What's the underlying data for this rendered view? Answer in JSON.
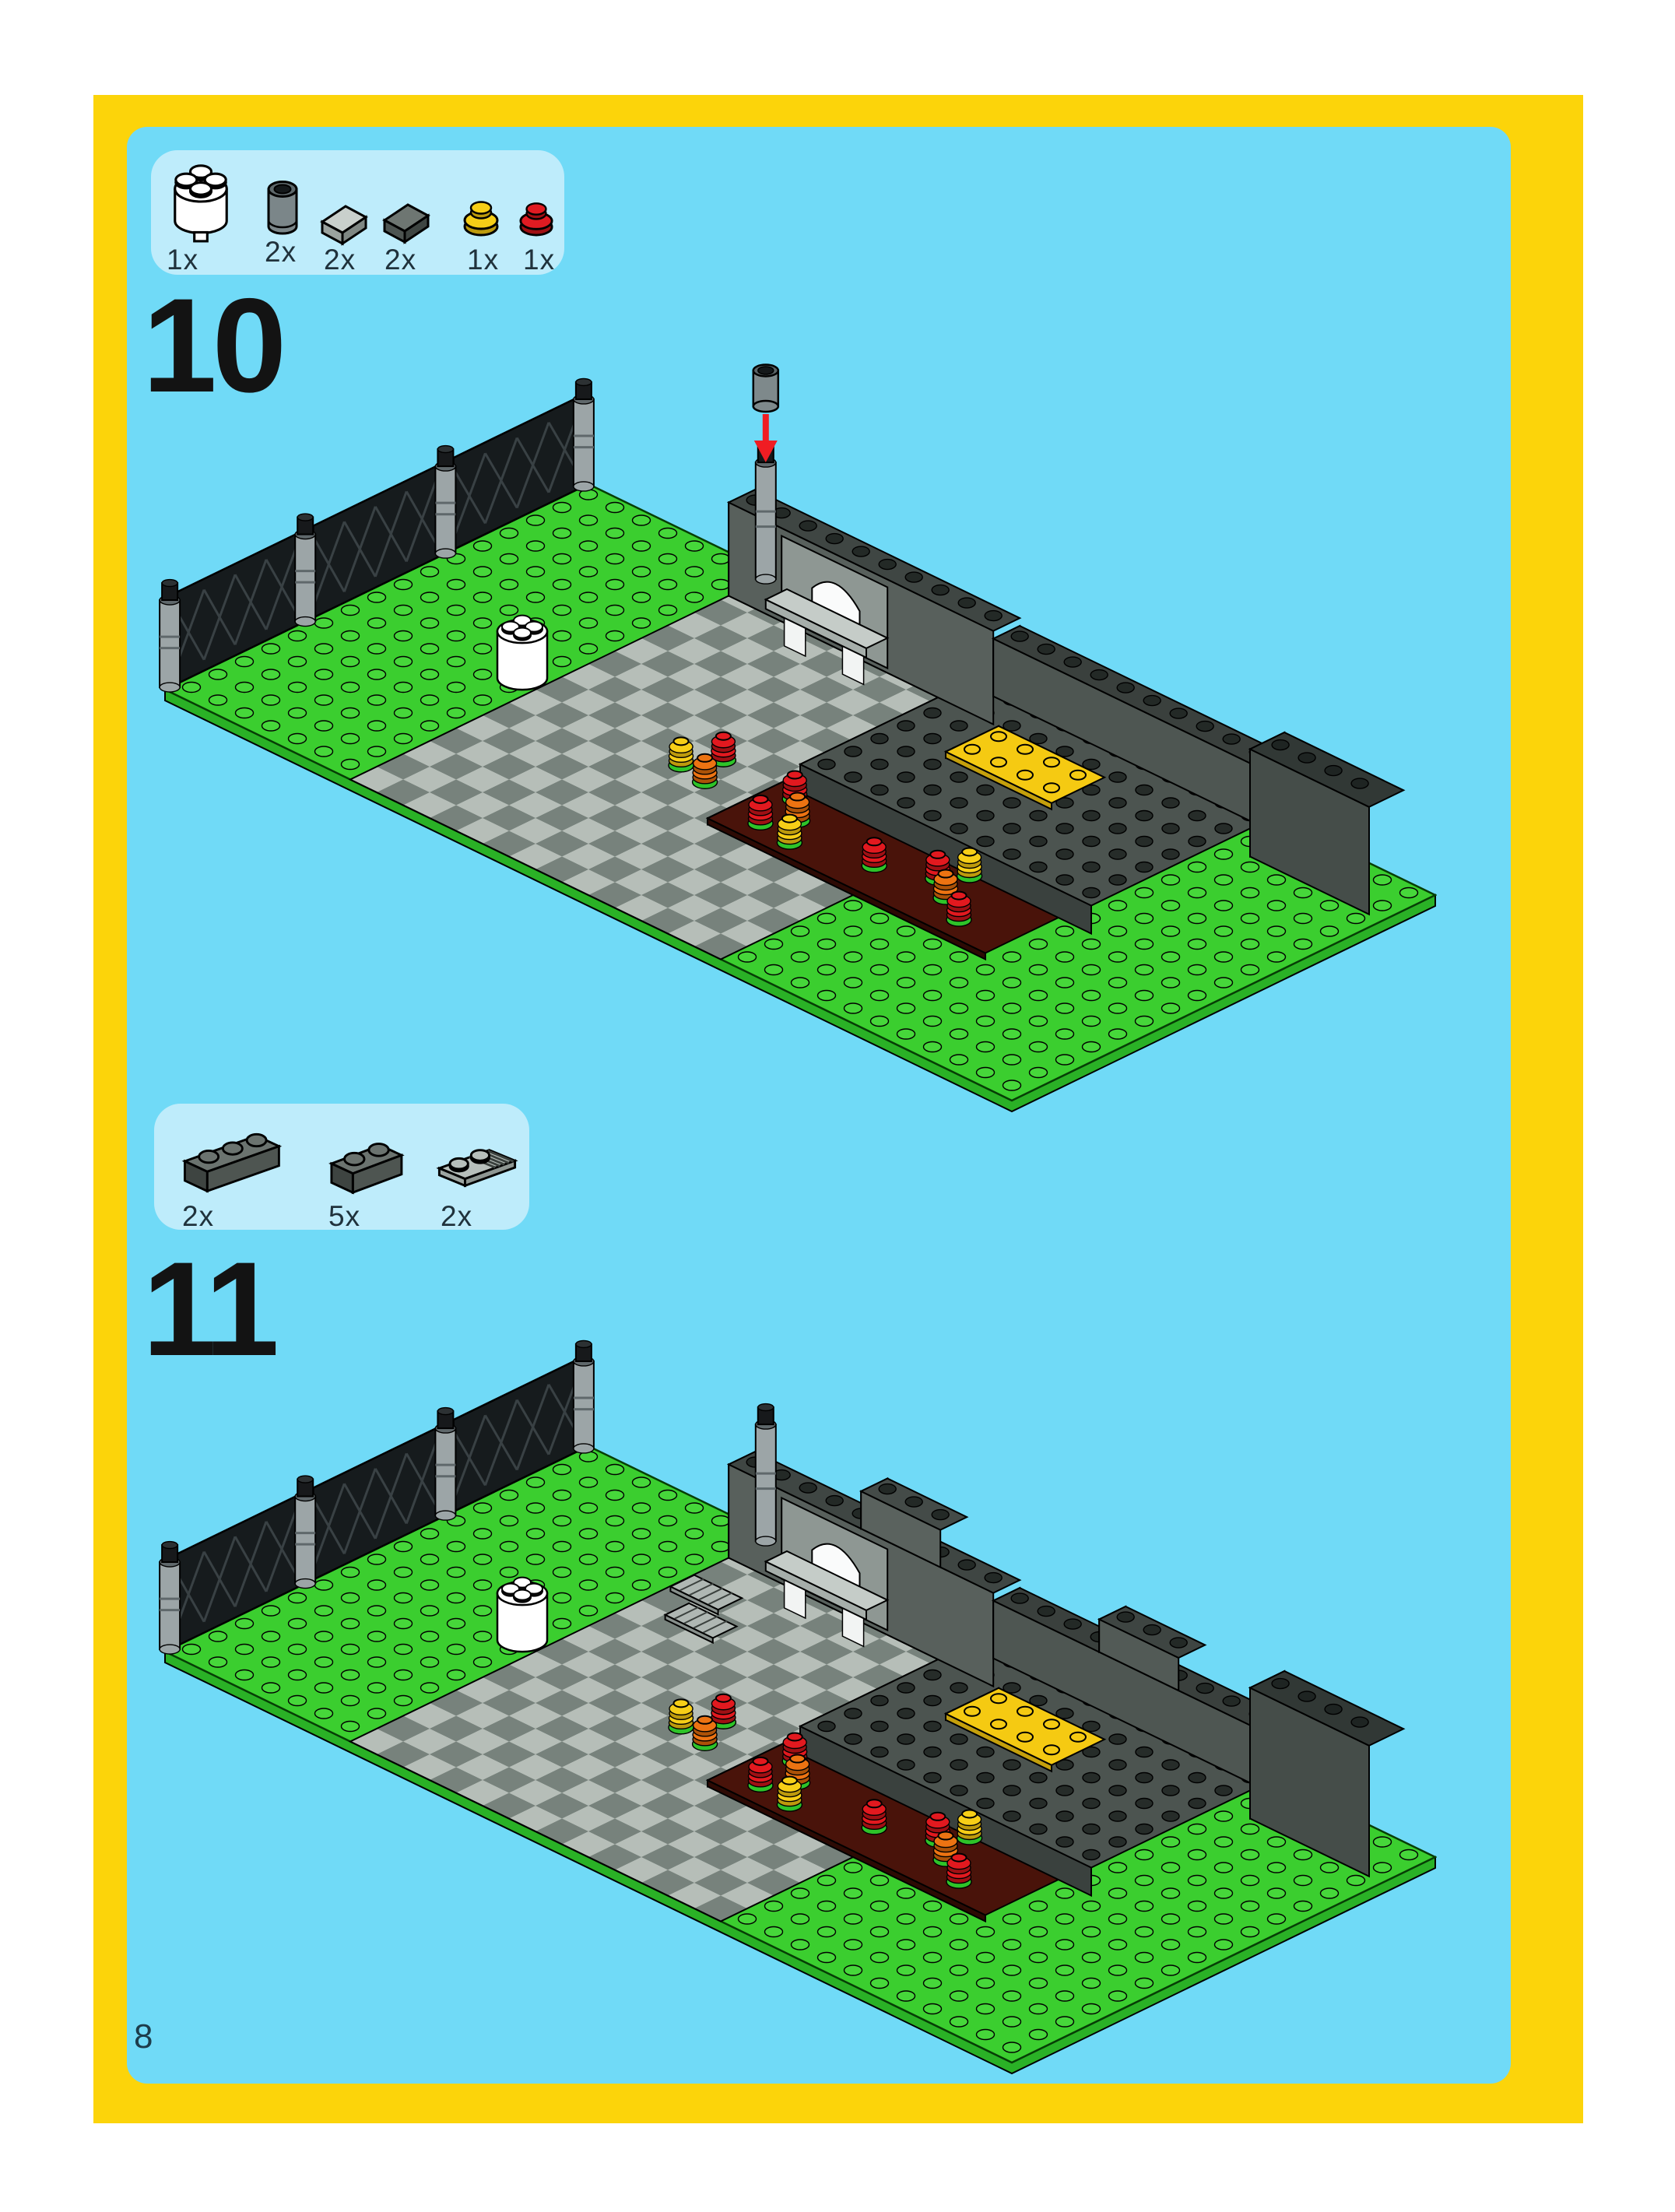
{
  "page_number": "8",
  "steps": [
    {
      "number": "10",
      "parts": [
        {
          "count": "1x",
          "piece": "white-round-brick-2x2",
          "color": "#FFFFFF"
        },
        {
          "count": "2x",
          "piece": "dark-gray-round-brick-1x1",
          "color": "#7B8689"
        },
        {
          "count": "2x",
          "piece": "light-gray-slope-1x1",
          "color": "#C9D0CC"
        },
        {
          "count": "2x",
          "piece": "dark-gray-slope-1x1",
          "color": "#6E7672"
        },
        {
          "count": "1x",
          "piece": "yellow-round-plate-1x1",
          "color": "#F6CE17"
        },
        {
          "count": "1x",
          "piece": "red-round-plate-1x1",
          "color": "#E01B22"
        }
      ],
      "has_placement_arrow": true
    },
    {
      "number": "11",
      "parts": [
        {
          "count": "2x",
          "piece": "dark-gray-brick-1x3",
          "color": "#5E6663"
        },
        {
          "count": "5x",
          "piece": "dark-gray-brick-1x2",
          "color": "#5E6663"
        },
        {
          "count": "2x",
          "piece": "light-gray-grille-plate-1x2",
          "color": "#B7BFBB"
        }
      ],
      "has_placement_arrow": false
    }
  ],
  "colors": {
    "frame_yellow": "#FCD40A",
    "background_blue": "#70DAF7",
    "parts_box_blue": "#BEECFB",
    "baseplate_green": "#3BCE2F",
    "path_light_gray": "#B6BEB8",
    "path_dark_gray": "#77827C",
    "wall_gray": "#58605C",
    "maroon_plate": "#49130A",
    "piece_red": "#E01B22",
    "piece_orange": "#EC7312",
    "piece_yellow": "#F6CE17",
    "arrow_red": "#F01D23"
  }
}
